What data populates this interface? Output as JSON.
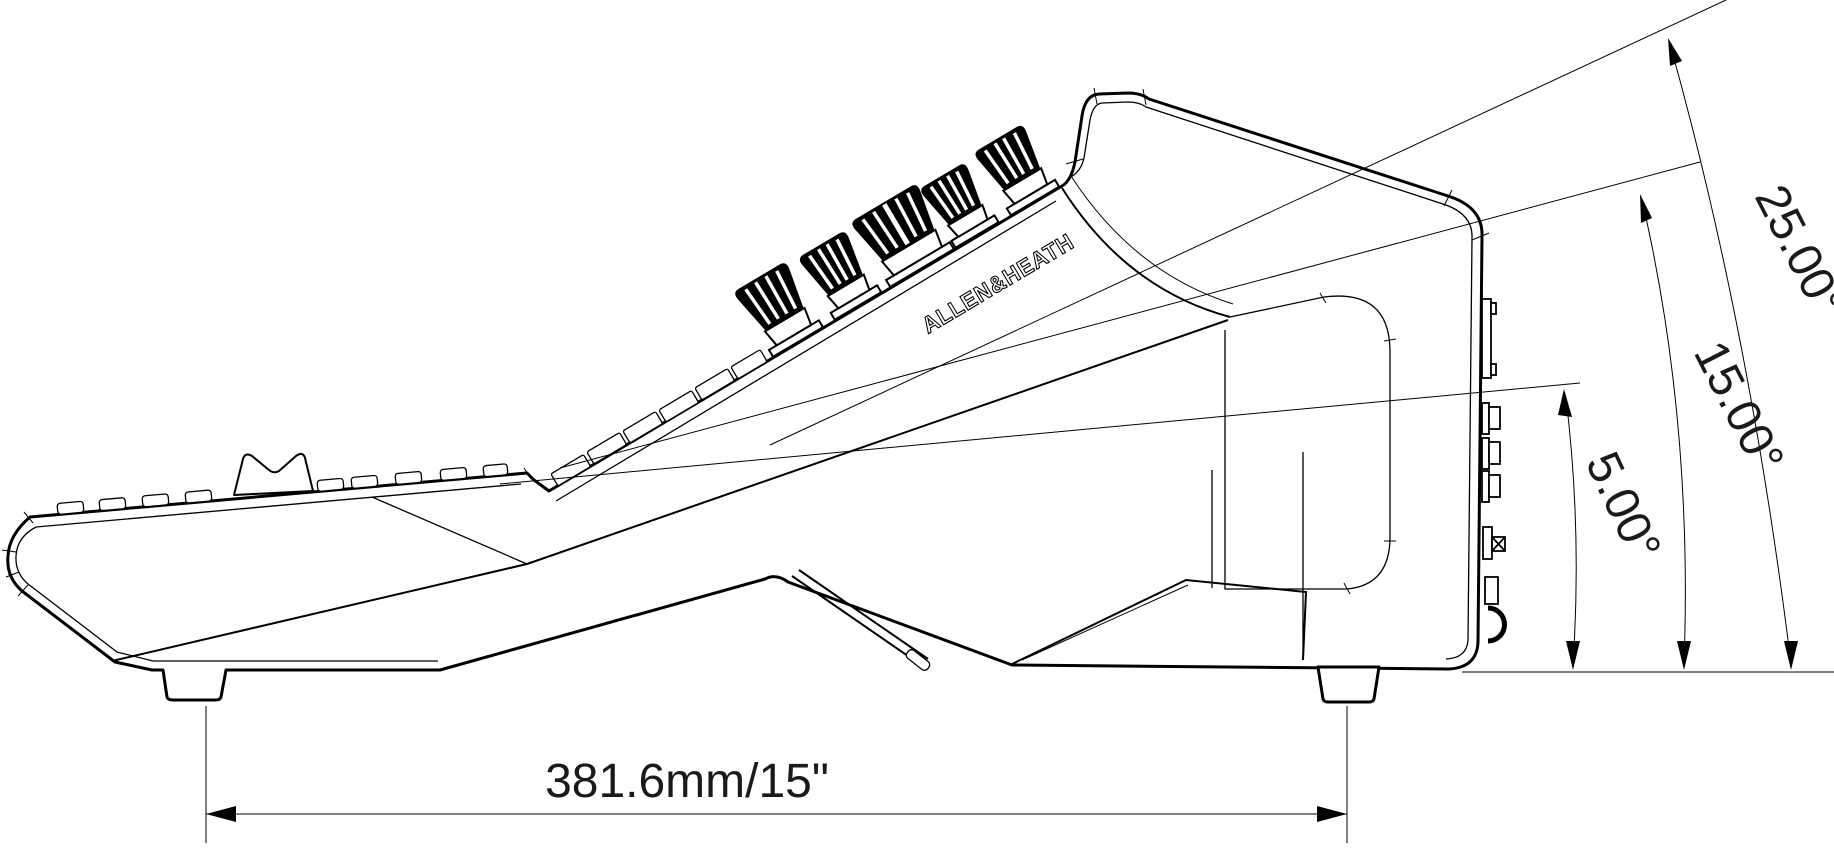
{
  "drawing": {
    "brand_label": "ALLEN&HEATH",
    "width_dimension_label": "381.6mm/15\"",
    "angle_labels": {
      "a25": "25.00°",
      "a15": "15.00°",
      "a5": "5.00°"
    },
    "colors": {
      "line": "#000000",
      "background": "#ffffff"
    }
  }
}
